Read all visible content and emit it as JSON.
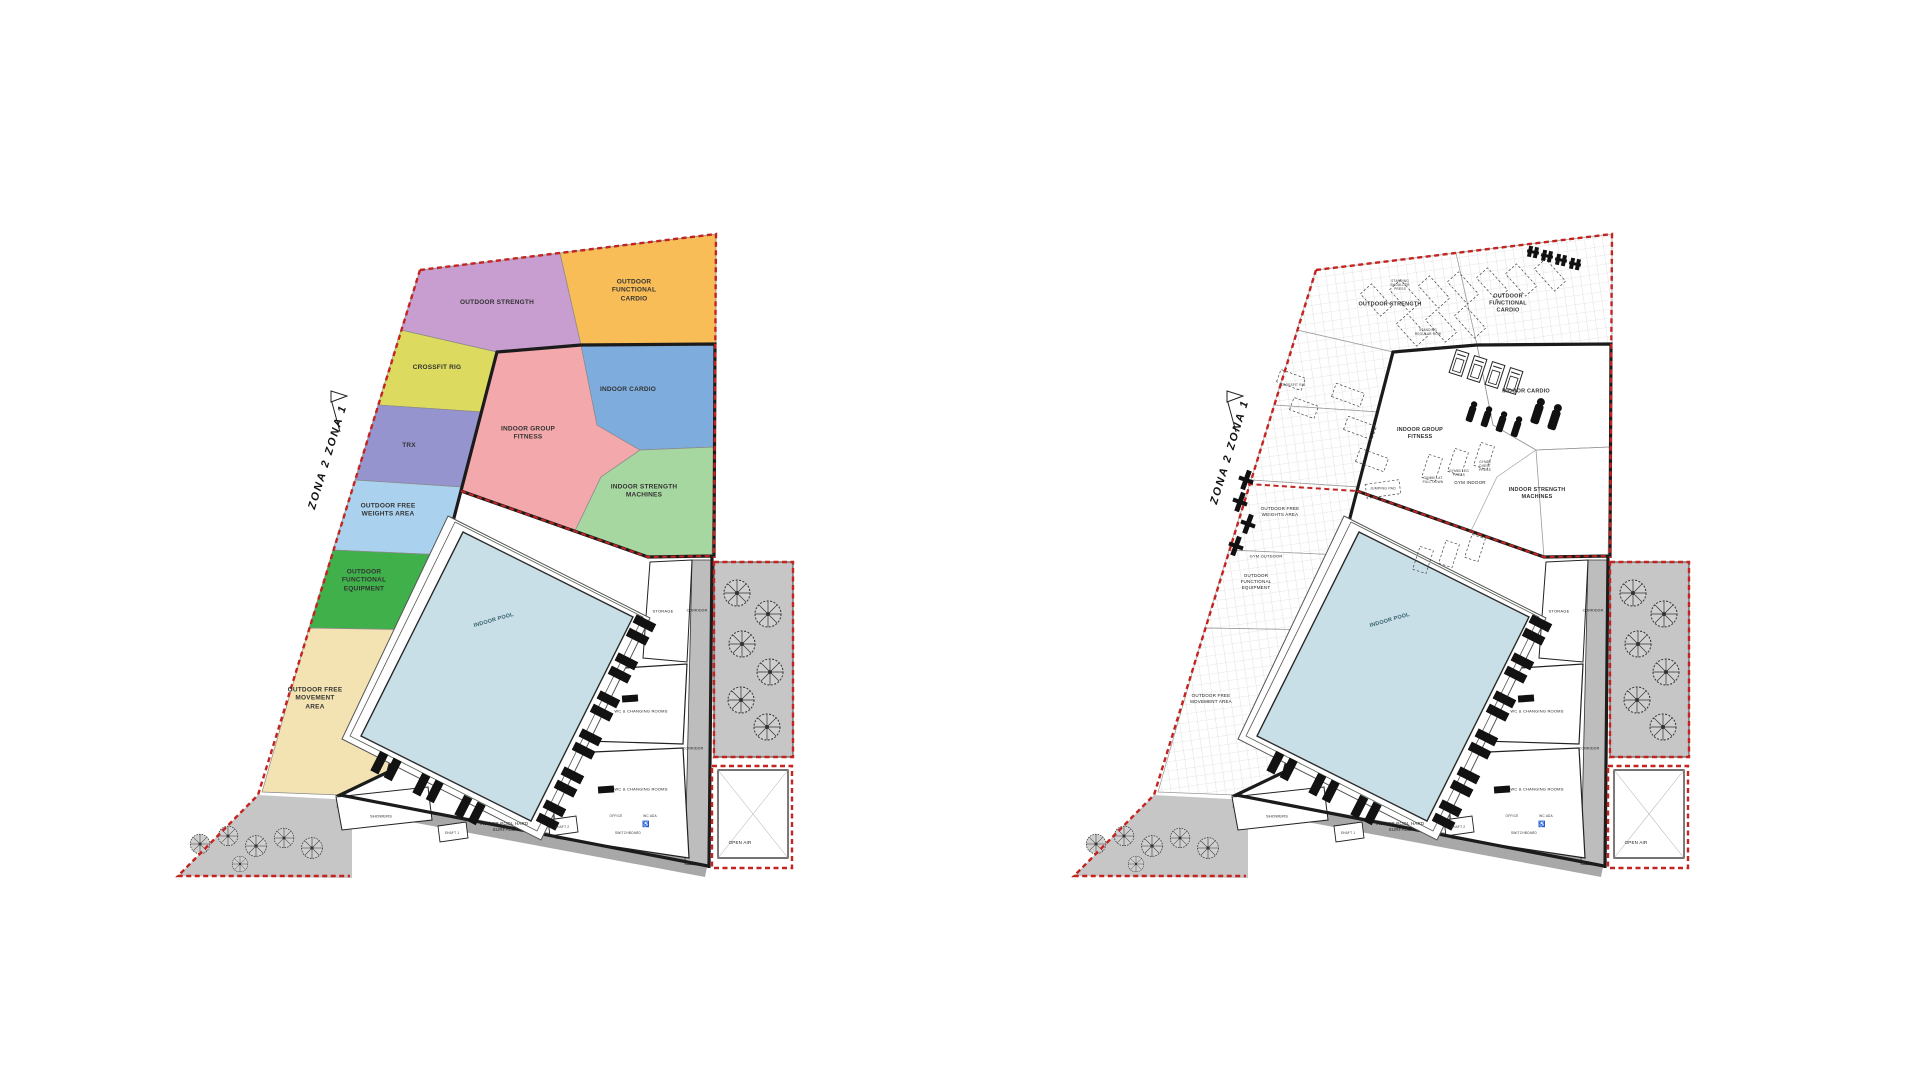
{
  "page": {
    "title": "Fitness centre site zoning and equipment plan"
  },
  "colors": {
    "boundary_red": "#c4231f",
    "wall_black": "#1b1b1b",
    "courtyard_gray": "#c6c6c6",
    "sidewalk_gray": "#a8a8a8",
    "corridor_gray": "#bdbdbd",
    "grid_gray": "#cfcfcf"
  },
  "site": {
    "zona_boundary_label": "ZONA 2   ZONA 1"
  },
  "zones": {
    "outdoor_strength": {
      "label": "OUTDOOR STRENGTH",
      "color": "#c79ecf"
    },
    "outdoor_functional_cardio": {
      "label": "OUTDOOR FUNCTIONAL CARDIO",
      "color": "#f8bd57"
    },
    "crossfit_rig": {
      "label": "CROSSFIT RIG",
      "color": "#dcda5f"
    },
    "trx": {
      "label": "TRX",
      "color": "#9694ce"
    },
    "outdoor_free_weights": {
      "label": "OUTDOOR FREE WEIGHTS AREA",
      "color": "#aad2ef"
    },
    "outdoor_functional_equipment": {
      "label": "OUTDOOR FUNCTIONAL EQUIPMENT",
      "color": "#3fb04a"
    },
    "outdoor_free_movement": {
      "label": "OUTDOOR FREE MOVEMENT AREA",
      "color": "#f4e3b2"
    },
    "indoor_group_fitness": {
      "label": "INDOOR GROUP FITNESS",
      "color": "#f3a8ac"
    },
    "indoor_cardio": {
      "label": "INDOOR CARDIO",
      "color": "#7dacdd"
    },
    "indoor_strength_machines": {
      "label": "INDOOR STRENGTH MACHINES",
      "color": "#a7d7a0"
    },
    "indoor_pool": {
      "label": "INDOOR POOL",
      "color": "#c9dfe8"
    }
  },
  "rooms": {
    "storage": "STORAGE",
    "corridor": "CORRIDOR",
    "wc_changing": "WC & CHANGING ROOMS",
    "office": "OFFICE",
    "wc_ada": "WC ADA",
    "switchboard": "SWITCHBOARD",
    "showers": "SHOWERS",
    "shaft_1": "SHAFT 1",
    "shaft_2": "SHAFT 2",
    "indoor_pool_hard_surface": "INDOOR POOL HARD SURFACE",
    "open_air": "OPEN AIR"
  },
  "right_plan": {
    "gym_indoor": "GYM INDOOR",
    "gym_outdoor": "GYM OUTDOOR",
    "jumping_pad": "JUMPING PAD",
    "crossfit_rig_tag": "CROSSFIT RIG",
    "equipment_tags": [
      "GYM80 LAT PULL DOWN",
      "GYM80 LEG PRESS",
      "GYM80 CHEST PRESS",
      "STANDING SHOULDER PRESS",
      "STANDING REGULAR ROW"
    ]
  },
  "icons": {
    "wheelchair": "♿"
  }
}
